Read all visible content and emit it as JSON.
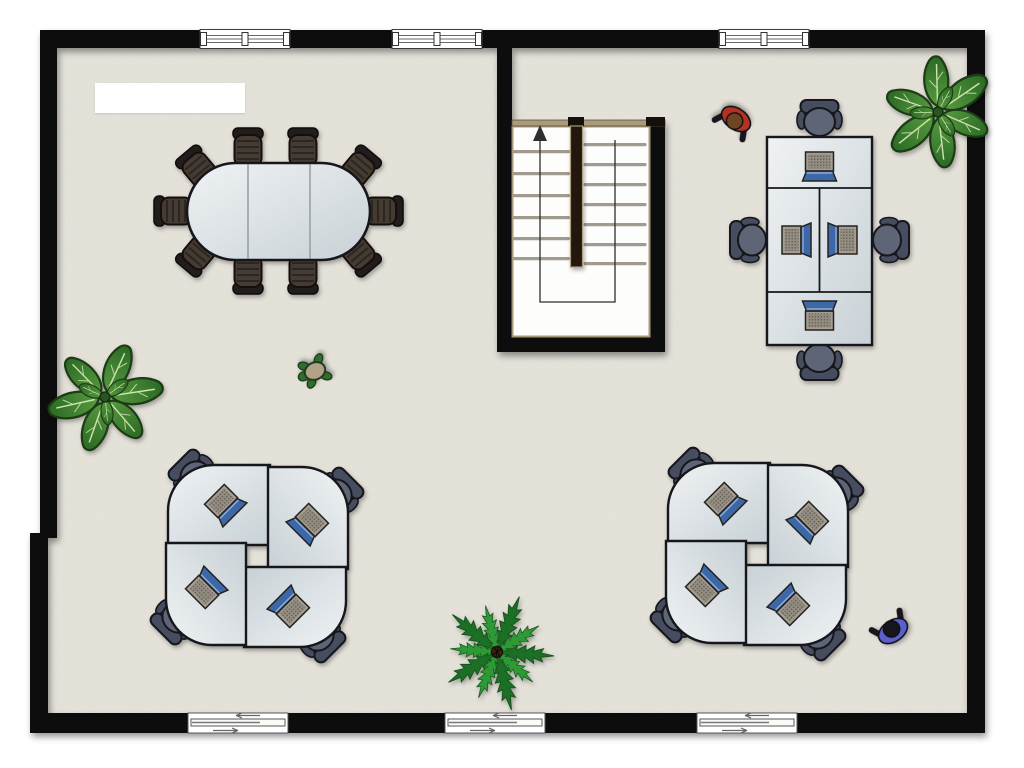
{
  "floorplan": {
    "label_box_text": "",
    "stairs": {
      "direction": "up",
      "flights": 2,
      "left_steps": 6,
      "right_steps": 7
    },
    "windows": {
      "count": 3,
      "wall": "top"
    },
    "sliding_doors": {
      "count": 3,
      "wall": "bottom"
    },
    "conference_area": {
      "table_sections": 3,
      "chair_count": 10
    },
    "workstations": [
      {
        "id": "quad-bank",
        "location": "top-right",
        "desks": 4,
        "chairs": 4,
        "laptops": 4
      },
      {
        "id": "pinwheel-a",
        "location": "bottom-left",
        "desks": 4,
        "chairs": 4,
        "laptops": 4
      },
      {
        "id": "pinwheel-b",
        "location": "bottom-right",
        "desks": 4,
        "chairs": 4,
        "laptops": 4
      }
    ],
    "plants": [
      {
        "type": "broadleaf",
        "location": "left-wall"
      },
      {
        "type": "broadleaf",
        "location": "top-right-corner"
      },
      {
        "type": "fern",
        "location": "bottom-center"
      }
    ],
    "people": [
      {
        "shirt_color": "#b23328",
        "hair_color": "#6e4423",
        "location": "top-center"
      },
      {
        "shirt_color": "#5a5ec9",
        "hair_color": "#17171a",
        "location": "bottom-right"
      }
    ],
    "pet": {
      "type": "turtle",
      "location": "left-of-stairwell"
    },
    "colors": {
      "outside": "#ffffff",
      "floor": "#e5e3da",
      "wall": "#0c0a09",
      "desk_stroke": "#16181a",
      "chair_body": "#5d6577",
      "chair_back": "#454d5f",
      "chair_conf": "#453b31",
      "chair_conf_dark": "#241f1a",
      "laptop_screen": "#a39d93",
      "laptop_base": "#3e68a8",
      "leaf_stroke": "#1b3a12",
      "fern_a": "#2e9a36",
      "fern_b": "#1f7026",
      "stair_trim": "#a99a79",
      "stair_divider": "#221911",
      "path_line": "#2e2e2e",
      "p1_shirt": "#b23328",
      "p1_hair": "#6e4423",
      "p2_shirt": "#5a5ec9",
      "p2_hair": "#17171a",
      "turtle_body": "#2f6d2f",
      "turtle_shell": "#b2a287"
    }
  }
}
